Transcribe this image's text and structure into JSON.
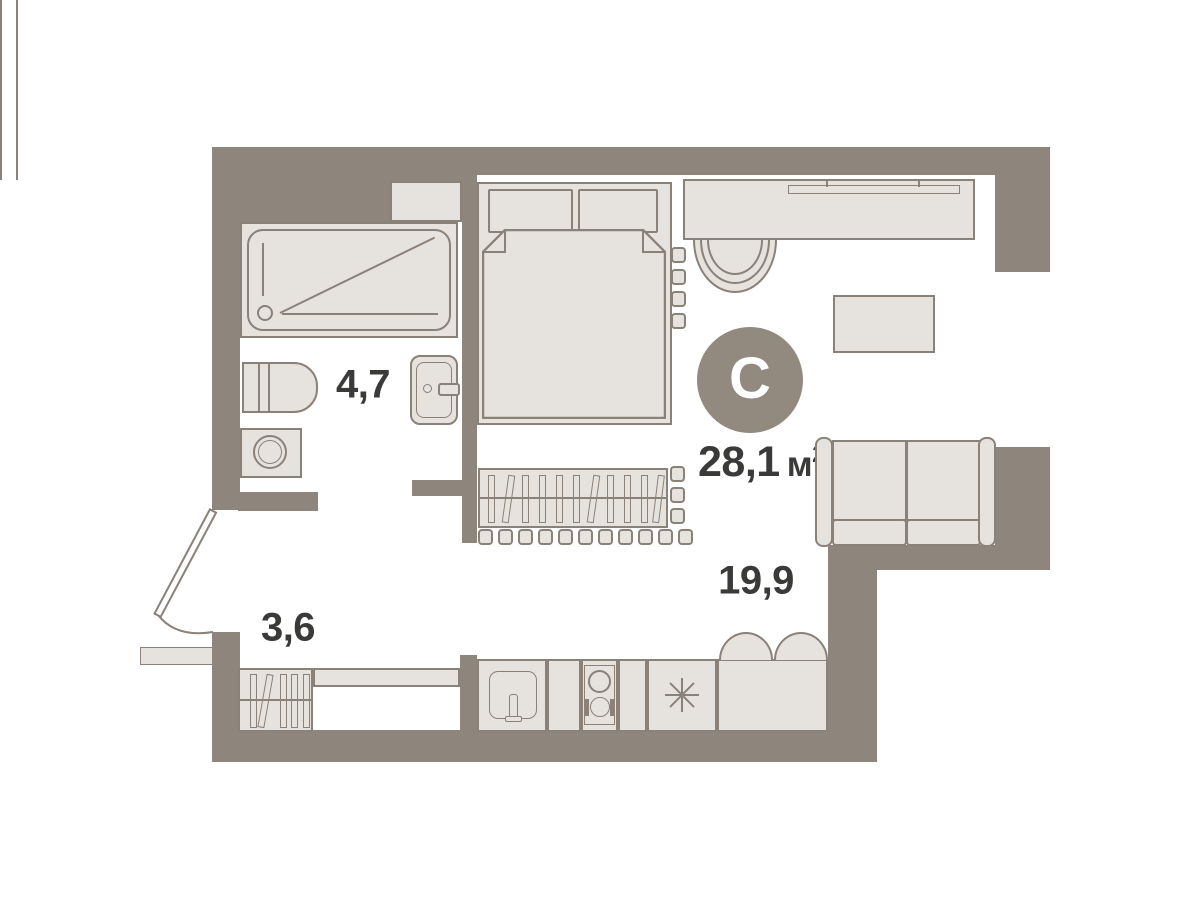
{
  "plan": {
    "compass": {
      "label": "С"
    },
    "total_area": {
      "value": "28,1",
      "unit": "м",
      "superscript": "2"
    },
    "rooms": [
      {
        "id": "bathroom",
        "area_label": "4,7"
      },
      {
        "id": "hallway",
        "area_label": "3,6"
      },
      {
        "id": "living-kitchen",
        "area_label": "19,9"
      }
    ],
    "colors": {
      "wall": "#8e867d",
      "furniture_fill": "#e6e3de",
      "outline": "#8a8178",
      "text": "#3a3a38",
      "compass_background": "#938a7f",
      "background": "#ffffff"
    }
  }
}
